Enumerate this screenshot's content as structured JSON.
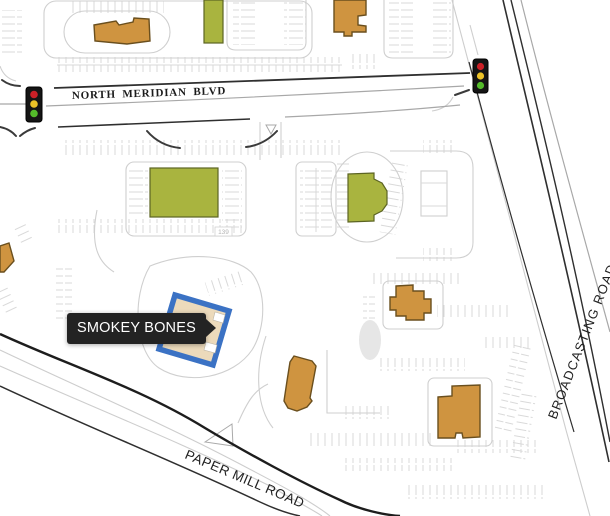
{
  "map": {
    "labels": {
      "north_meridian": "NORTH MERIDIAN BLVD",
      "broadcasting": "BROADCASTING ROAD",
      "paper_mill": "PAPER MILL ROAD",
      "stall_count": "139"
    },
    "tooltip": {
      "text": "SMOKEY BONES"
    },
    "icons": [
      "traffic-light-icon",
      "tooltip-arrow-icon"
    ],
    "colors": {
      "building_orange": "#cf9440",
      "building_orange_border": "#6a4f1e",
      "building_green": "#a9b43f",
      "building_green_border": "#5c6423",
      "highlight_blue": "#3b72c4",
      "highlight_fill": "#ecdabb",
      "tooltip_bg": "#232323",
      "tooltip_text": "#ffffff",
      "parking_line": "#d9d9d9",
      "road_dark": "#2f2f2f",
      "signal_red": "#cb2027",
      "signal_amber": "#ecc227",
      "signal_green": "#54bb2a"
    }
  }
}
